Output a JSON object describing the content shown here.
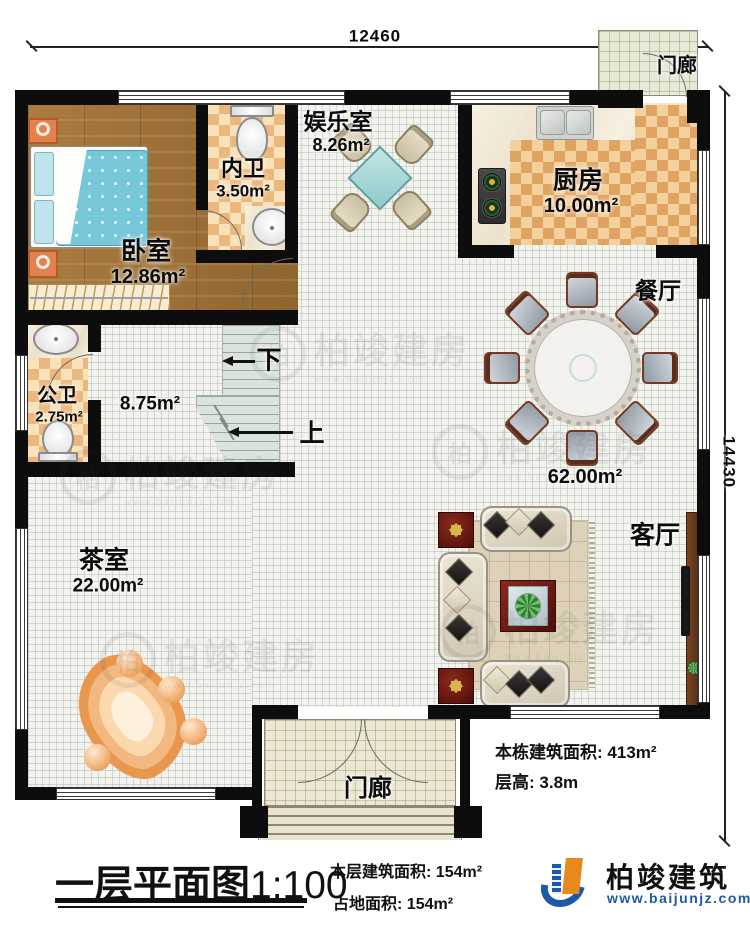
{
  "dimensions": {
    "top": "12460",
    "right": "14430"
  },
  "rooms": {
    "bedroom": {
      "name": "卧室",
      "area": "12.86m²"
    },
    "inner_bath": {
      "name": "内卫",
      "area": "3.50m²"
    },
    "entertainment": {
      "name": "娱乐室",
      "area": "8.26m²"
    },
    "kitchen": {
      "name": "厨房",
      "area": "10.00m²"
    },
    "porch_top": {
      "name": "门廊"
    },
    "dining": {
      "name": "餐厅"
    },
    "hall": {
      "area": "62.00m²"
    },
    "stair_hall": {
      "area": "8.75m²"
    },
    "public_bath": {
      "name": "公卫",
      "area": "2.75m²"
    },
    "tea_room": {
      "name": "茶室",
      "area": "22.00m²"
    },
    "living": {
      "name": "客厅"
    },
    "porch_bottom": {
      "name": "门廊"
    }
  },
  "stairs": {
    "down": "下",
    "up": "上"
  },
  "title": {
    "text": "一层平面图",
    "scale": "1:100"
  },
  "stats": {
    "building_total": {
      "label": "本栋建筑面积:",
      "value": "413m²"
    },
    "floor_height": {
      "label": "层高:",
      "value": "3.8m"
    },
    "floor_area": {
      "label": "本层建筑面积:",
      "value": "154m²"
    },
    "land_area": {
      "label": "占地面积:",
      "value": "154m²"
    }
  },
  "brand": {
    "name": "柏竣建筑",
    "url": "www.baijunjz.com"
  },
  "watermark": {
    "text": "柏竣建房",
    "badge": "柏"
  },
  "colors": {
    "wall": "#0d0d0d",
    "accent_blue": "#1e59a8",
    "accent_orange": "#e8891d"
  }
}
